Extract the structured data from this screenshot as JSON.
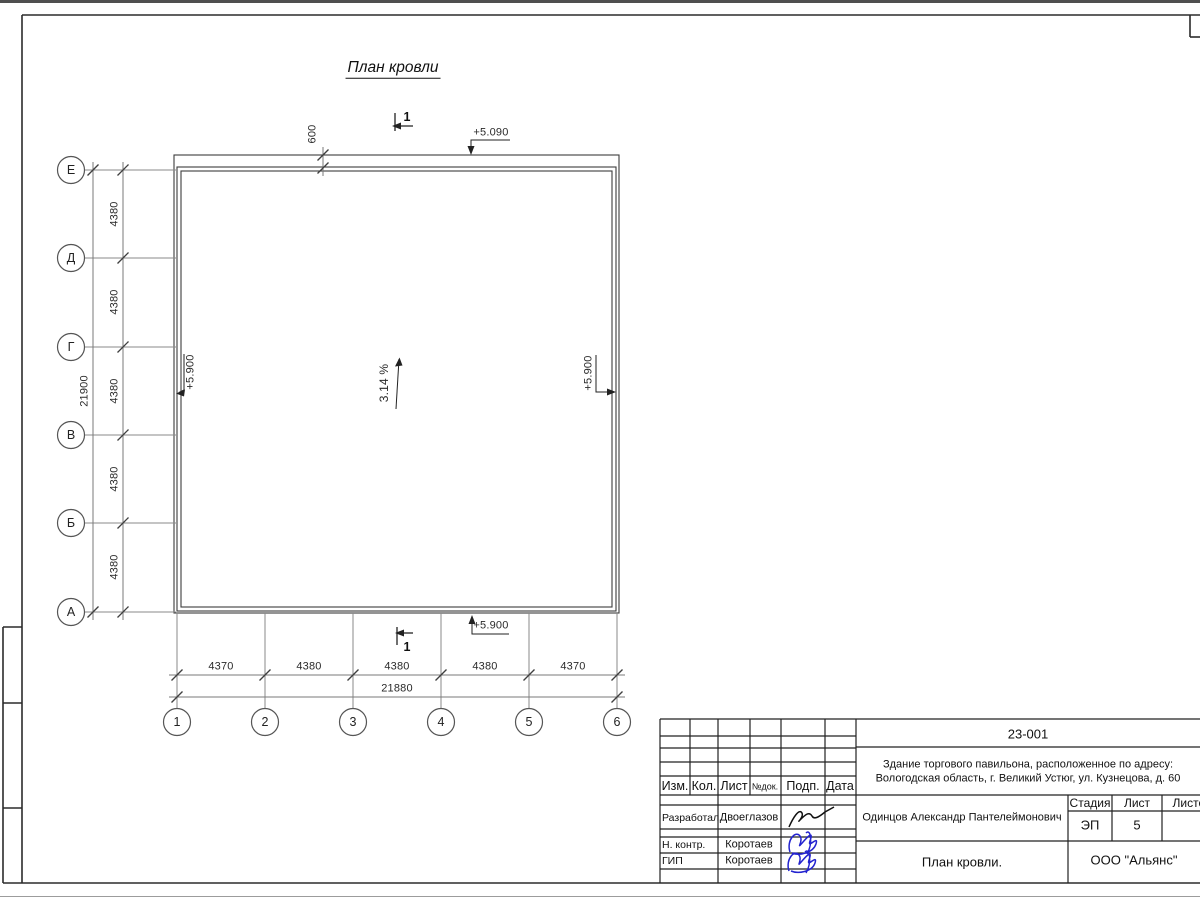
{
  "drawing": {
    "title": "План кровли",
    "axes_left": [
      "Е",
      "Д",
      "Г",
      "В",
      "Б",
      "А"
    ],
    "axes_bottom": [
      "1",
      "2",
      "3",
      "4",
      "5",
      "6"
    ],
    "left_segment_dims": [
      "4380",
      "4380",
      "4380",
      "4380",
      "4380"
    ],
    "left_total_dim": "21900",
    "bottom_segment_dims": [
      "4370",
      "4380",
      "4380",
      "4380",
      "4370"
    ],
    "bottom_total_dim": "21880",
    "eave_dim": "600",
    "slope_label": "3.14 %",
    "elevation_top": "+5.090",
    "elevation_left": "+5.900",
    "elevation_right": "+5.900",
    "elevation_bottom": "+5.900",
    "section_mark": "1"
  },
  "title_block": {
    "doc_number": "23-001",
    "object_address_line1": "Здание торгового павильона, расположенное по адресу:",
    "object_address_line2": "Вологодская область, г. Великий Устюг, ул. Кузнецова, д. 60",
    "col_izm": "Изм.",
    "col_kol": "Кол.",
    "col_list": "Лист",
    "col_ndok": "№док.",
    "col_podp": "Подп.",
    "col_data": "Дата",
    "role_developed": "Разработал",
    "name_developed": "Двоеглазов",
    "role_ncontr": "Н. контр.",
    "name_ncontr": "Коротаев",
    "role_gip": "ГИП",
    "name_gip": "Коротаев",
    "client": "Одинцов Александр Пантелеймонович",
    "stage_label": "Стадия",
    "sheet_label": "Лист",
    "sheets_label": "Листов",
    "stage_value": "ЭП",
    "sheet_value": "5",
    "drawing_name": "План кровли.",
    "company": "ООО \"Альянс\""
  }
}
